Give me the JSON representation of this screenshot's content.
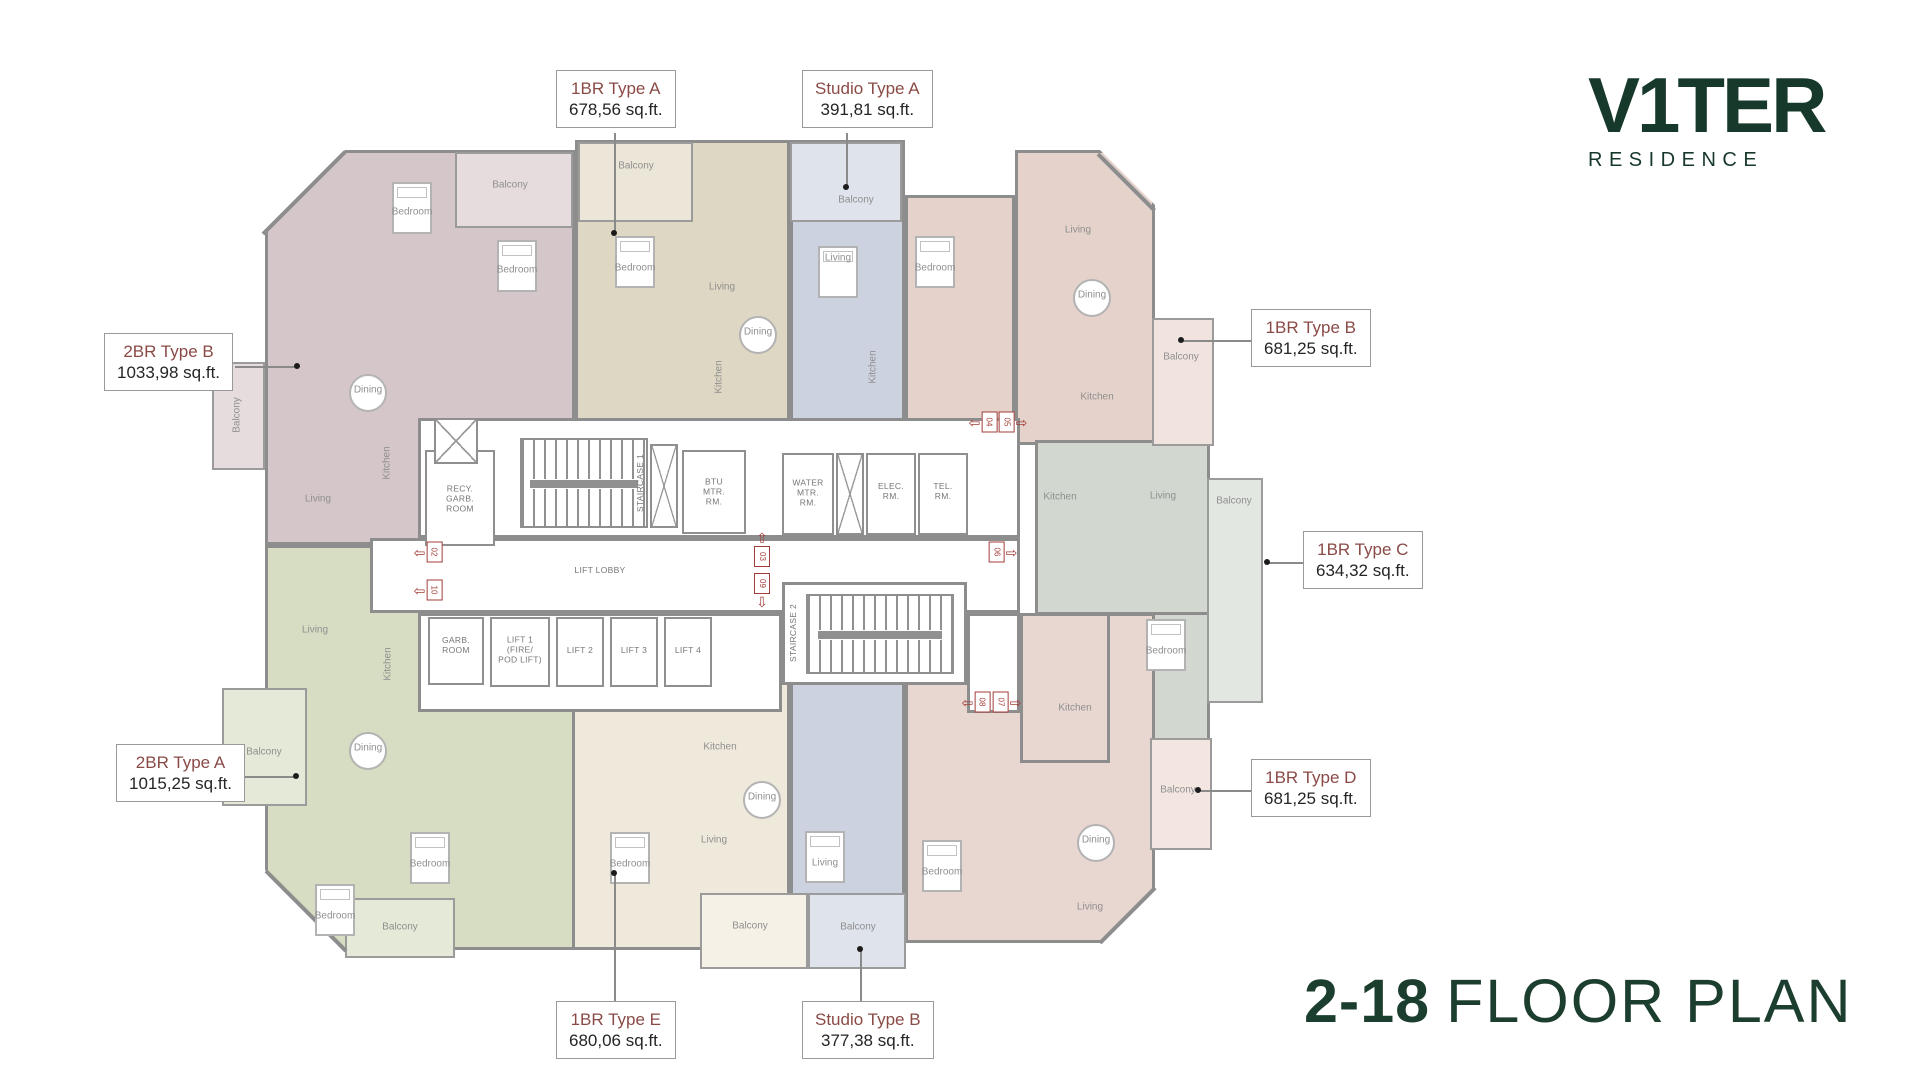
{
  "brand": {
    "name": "V1TER",
    "subtitle": "RESIDENCE"
  },
  "floor_title": {
    "floors": "2-18",
    "label": "FLOOR PLAN"
  },
  "colors": {
    "brand_green": "#17392b",
    "title_green": "#1c3e2e",
    "callout_maroon": "#8a4a46",
    "marker_red": "#a33d39",
    "wall_gray": "#8d8d8d",
    "unit_2br_b_mauve": "#d5c7c9",
    "unit_1br_a_beige": "#ded7c3",
    "unit_studio_blue": "#cdd2e0",
    "unit_1br_b_pink": "#e5d2cb",
    "unit_2br_a_sage": "#d6ddc2",
    "unit_1br_e_cream": "#efe9db",
    "unit_1br_c_graygreen": "#d2d8cf",
    "unit_1br_d_pink": "#e8d6d0"
  },
  "callouts": [
    {
      "name": "1BR Type A",
      "area": "678,56 sq.ft."
    },
    {
      "name": "Studio Type A",
      "area": "391,81 sq.ft."
    },
    {
      "name": "2BR Type B",
      "area": "1033,98 sq.ft."
    },
    {
      "name": "1BR Type B",
      "area": "681,25 sq.ft."
    },
    {
      "name": "1BR Type C",
      "area": "634,32 sq.ft."
    },
    {
      "name": "2BR Type A",
      "area": "1015,25 sq.ft."
    },
    {
      "name": "1BR Type D",
      "area": "681,25 sq.ft."
    },
    {
      "name": "1BR Type E",
      "area": "680,06 sq.ft."
    },
    {
      "name": "Studio Type B",
      "area": "377,38 sq.ft."
    }
  ],
  "plan": {
    "room_labels": [
      {
        "t": "Bedroom",
        "x": 412,
        "y": 212
      },
      {
        "t": "Bedroom",
        "x": 517,
        "y": 270
      },
      {
        "t": "Dining",
        "x": 368,
        "y": 390
      },
      {
        "t": "Kitchen",
        "x": 387,
        "y": 463,
        "rot": true
      },
      {
        "t": "Living",
        "x": 318,
        "y": 499
      },
      {
        "t": "Balcony",
        "x": 510,
        "y": 185
      },
      {
        "t": "Balcony",
        "x": 237,
        "y": 415,
        "rot": true
      },
      {
        "t": "Bedroom",
        "x": 635,
        "y": 268
      },
      {
        "t": "Living",
        "x": 722,
        "y": 287
      },
      {
        "t": "Dining",
        "x": 758,
        "y": 332
      },
      {
        "t": "Kitchen",
        "x": 719,
        "y": 377,
        "rot": true
      },
      {
        "t": "Balcony",
        "x": 636,
        "y": 166
      },
      {
        "t": "Living",
        "x": 838,
        "y": 258
      },
      {
        "t": "Kitchen",
        "x": 873,
        "y": 367,
        "rot": true
      },
      {
        "t": "Balcony",
        "x": 856,
        "y": 200
      },
      {
        "t": "Bedroom",
        "x": 935,
        "y": 268
      },
      {
        "t": "Living",
        "x": 1078,
        "y": 230
      },
      {
        "t": "Dining",
        "x": 1092,
        "y": 295
      },
      {
        "t": "Kitchen",
        "x": 1097,
        "y": 397
      },
      {
        "t": "Balcony",
        "x": 1181,
        "y": 357
      },
      {
        "t": "Kitchen",
        "x": 1060,
        "y": 497
      },
      {
        "t": "Living",
        "x": 1163,
        "y": 496
      },
      {
        "t": "Bedroom",
        "x": 1166,
        "y": 651
      },
      {
        "t": "Balcony",
        "x": 1234,
        "y": 501
      },
      {
        "t": "Living",
        "x": 315,
        "y": 630
      },
      {
        "t": "Kitchen",
        "x": 388,
        "y": 664,
        "rot": true
      },
      {
        "t": "Dining",
        "x": 368,
        "y": 748
      },
      {
        "t": "Balcony",
        "x": 264,
        "y": 752
      },
      {
        "t": "Bedroom",
        "x": 430,
        "y": 864
      },
      {
        "t": "Bedroom",
        "x": 335,
        "y": 916
      },
      {
        "t": "Balcony",
        "x": 400,
        "y": 927
      },
      {
        "t": "Kitchen",
        "x": 720,
        "y": 747
      },
      {
        "t": "Dining",
        "x": 762,
        "y": 797
      },
      {
        "t": "Living",
        "x": 714,
        "y": 840
      },
      {
        "t": "Bedroom",
        "x": 630,
        "y": 864
      },
      {
        "t": "Balcony",
        "x": 750,
        "y": 926
      },
      {
        "t": "Living",
        "x": 825,
        "y": 863
      },
      {
        "t": "Balcony",
        "x": 858,
        "y": 927
      },
      {
        "t": "Kitchen",
        "x": 1075,
        "y": 708
      },
      {
        "t": "Dining",
        "x": 1096,
        "y": 840
      },
      {
        "t": "Living",
        "x": 1090,
        "y": 907
      },
      {
        "t": "Bedroom",
        "x": 942,
        "y": 872
      },
      {
        "t": "Balcony",
        "x": 1178,
        "y": 790
      },
      {
        "t": "RECY.\nGARB.\nROOM",
        "x": 460,
        "y": 499,
        "core": true
      },
      {
        "t": "STAIRCASE 1",
        "x": 641,
        "y": 483,
        "core": true,
        "rot": true
      },
      {
        "t": "BTU\nMTR.\nRM.",
        "x": 714,
        "y": 492,
        "core": true
      },
      {
        "t": "WATER\nMTR.\nRM.",
        "x": 808,
        "y": 493,
        "core": true
      },
      {
        "t": "ELEC.\nRM.",
        "x": 891,
        "y": 492,
        "core": true
      },
      {
        "t": "TEL.\nRM.",
        "x": 943,
        "y": 492,
        "core": true
      },
      {
        "t": "LIFT LOBBY",
        "x": 600,
        "y": 571,
        "core": true
      },
      {
        "t": "GARB.\nROOM",
        "x": 456,
        "y": 646,
        "core": true
      },
      {
        "t": "LIFT 1\n(FIRE/\nPOD LIFT)",
        "x": 520,
        "y": 650,
        "core": true
      },
      {
        "t": "LIFT 2",
        "x": 580,
        "y": 651,
        "core": true
      },
      {
        "t": "LIFT 3",
        "x": 634,
        "y": 651,
        "core": true
      },
      {
        "t": "LIFT 4",
        "x": 688,
        "y": 651,
        "core": true
      },
      {
        "t": "STAIRCASE 2",
        "x": 794,
        "y": 633,
        "core": true,
        "rot": true
      }
    ],
    "unit_markers": [
      {
        "num": "02",
        "x": 428,
        "y": 552,
        "dir": "left"
      },
      {
        "num": "10",
        "x": 428,
        "y": 590,
        "dir": "left"
      },
      {
        "num": "03",
        "x": 762,
        "y": 549,
        "dir": "up"
      },
      {
        "num": "09",
        "x": 762,
        "y": 591,
        "dir": "down"
      },
      {
        "num": "04",
        "x": 983,
        "y": 422,
        "dir": "left"
      },
      {
        "num": "05",
        "x": 1013,
        "y": 422,
        "dir": "right"
      },
      {
        "num": "06",
        "x": 1003,
        "y": 552,
        "dir": "right"
      },
      {
        "num": "08",
        "x": 976,
        "y": 702,
        "dir": "left"
      },
      {
        "num": "07",
        "x": 1007,
        "y": 702,
        "dir": "right"
      }
    ],
    "marker_arrows": {
      "left": "⇦",
      "right": "⇨",
      "up": "⇧",
      "down": "⇩"
    }
  }
}
